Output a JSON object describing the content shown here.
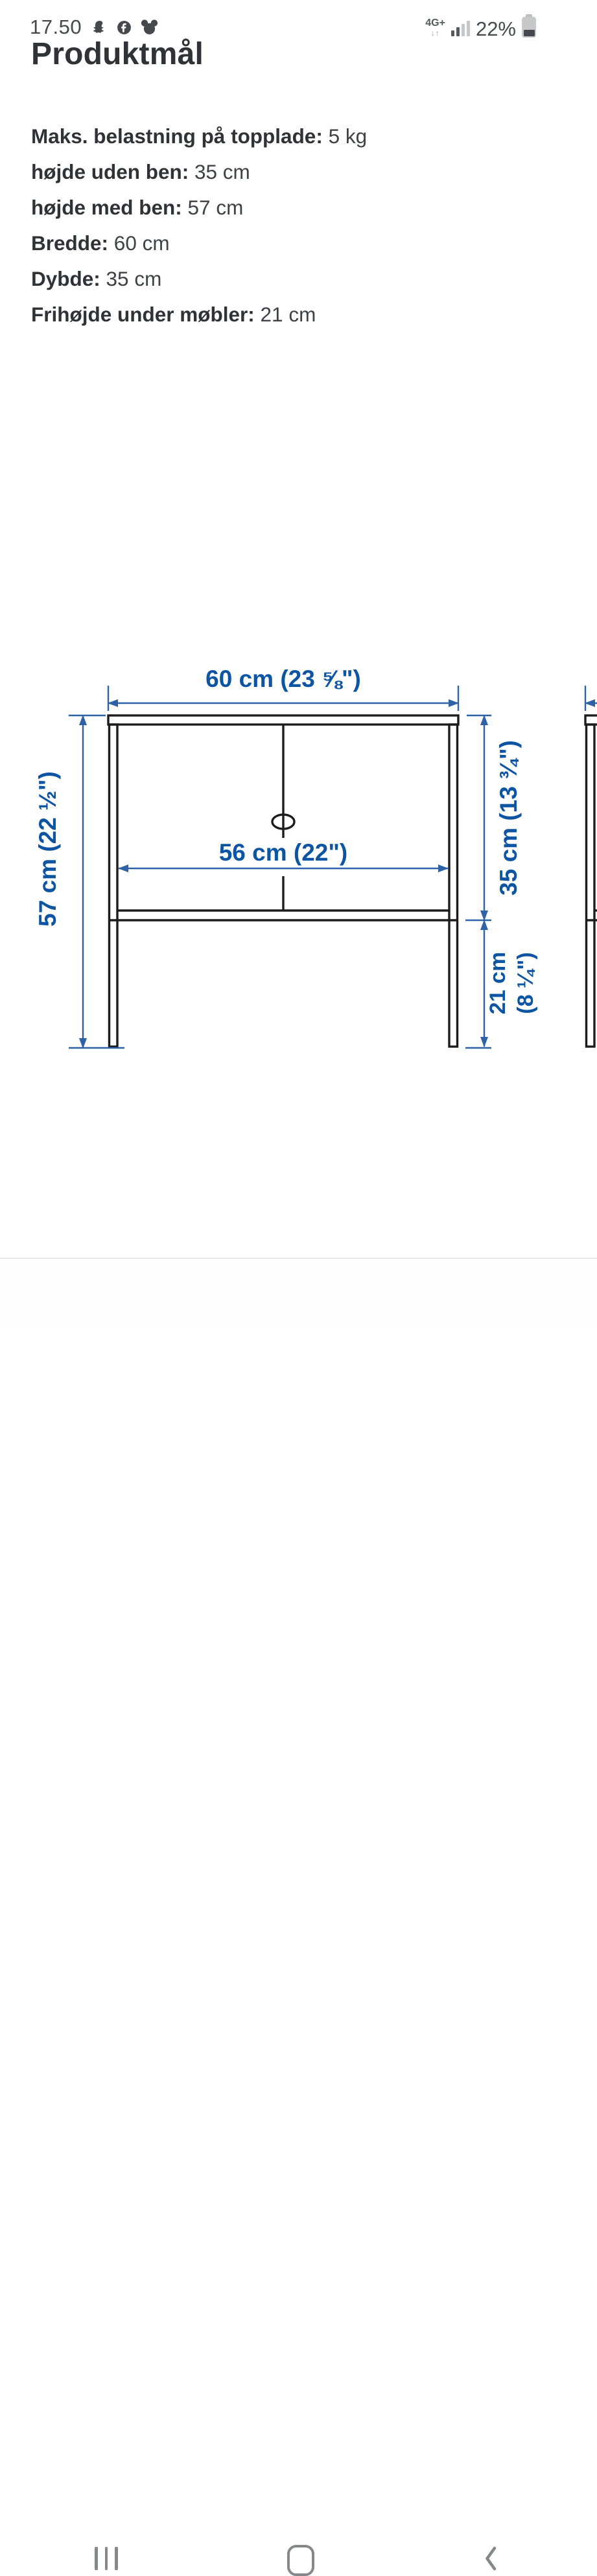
{
  "status_bar": {
    "time": "17.50",
    "notification_icons": [
      "snapchat-icon",
      "facebook-icon",
      "disney-icon"
    ],
    "network_label": "4G+",
    "network_arrows": "↓↑",
    "battery_percent": "22%"
  },
  "page": {
    "title": "Produktmål"
  },
  "specs": [
    {
      "label": "Maks. belastning på topplade:",
      "value": "5 kg"
    },
    {
      "label": "højde uden ben:",
      "value": "35 cm"
    },
    {
      "label": "højde med ben:",
      "value": "57 cm"
    },
    {
      "label": "Bredde:",
      "value": "60 cm"
    },
    {
      "label": "Dybde:",
      "value": "35 cm"
    },
    {
      "label": "Frihøjde under møbler:",
      "value": "21 cm"
    }
  ],
  "diagram": {
    "width_label": "60 cm (23 ⅝\")",
    "inner_width_label": "56 cm (22\")",
    "total_height_label": "57 cm (22 ½\")",
    "body_height_label": "35 cm (13 ¾\")",
    "clearance_line1": "21 cm",
    "clearance_line2": "(8 ¼\")",
    "colors": {
      "dimension_blue": "#0d55a3",
      "dimension_line_blue": "#2e61a6",
      "structure_black": "#1c1c1e"
    }
  },
  "nav_bar": {
    "buttons": [
      "recents",
      "home",
      "back"
    ]
  }
}
